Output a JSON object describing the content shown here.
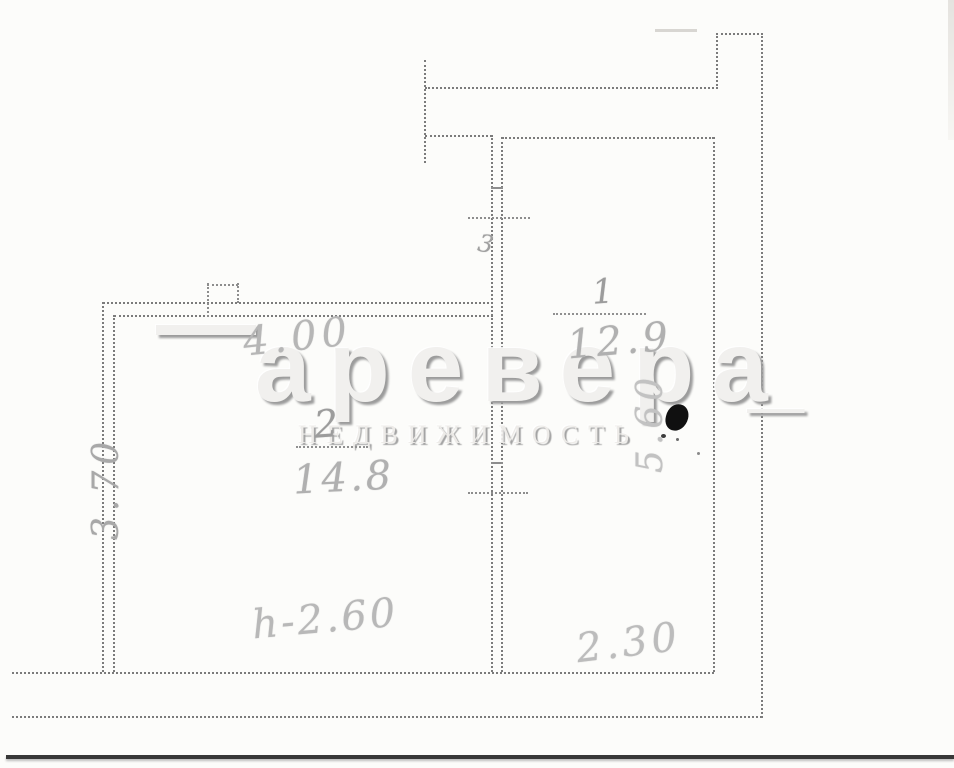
{
  "document": {
    "title": "Scanned apartment floor plan",
    "background_color": "#fcfcfa",
    "wall_line_color": "#7b7b7b",
    "pencil_color": "#b0b0b0",
    "scan_edge_color": "#383838"
  },
  "watermark": {
    "leading_mark": "—",
    "brand_text": "аревера",
    "trailing_mark": "_",
    "subtitle_text": "НЕДВИЖИМОСТЬ",
    "color": "#f1f0ee",
    "shadow_color": "#9c9c9c"
  },
  "rooms": [
    {
      "number": "1",
      "area_label": "12.9"
    },
    {
      "number": "2",
      "area_label": "14.8"
    }
  ],
  "dimensions": {
    "room2_width": "4.00",
    "room2_depth": "3.70",
    "room1_width": "2.30",
    "room1_depth": "5.60",
    "ceiling_height": "h-2.60",
    "stray_mark": "3"
  }
}
